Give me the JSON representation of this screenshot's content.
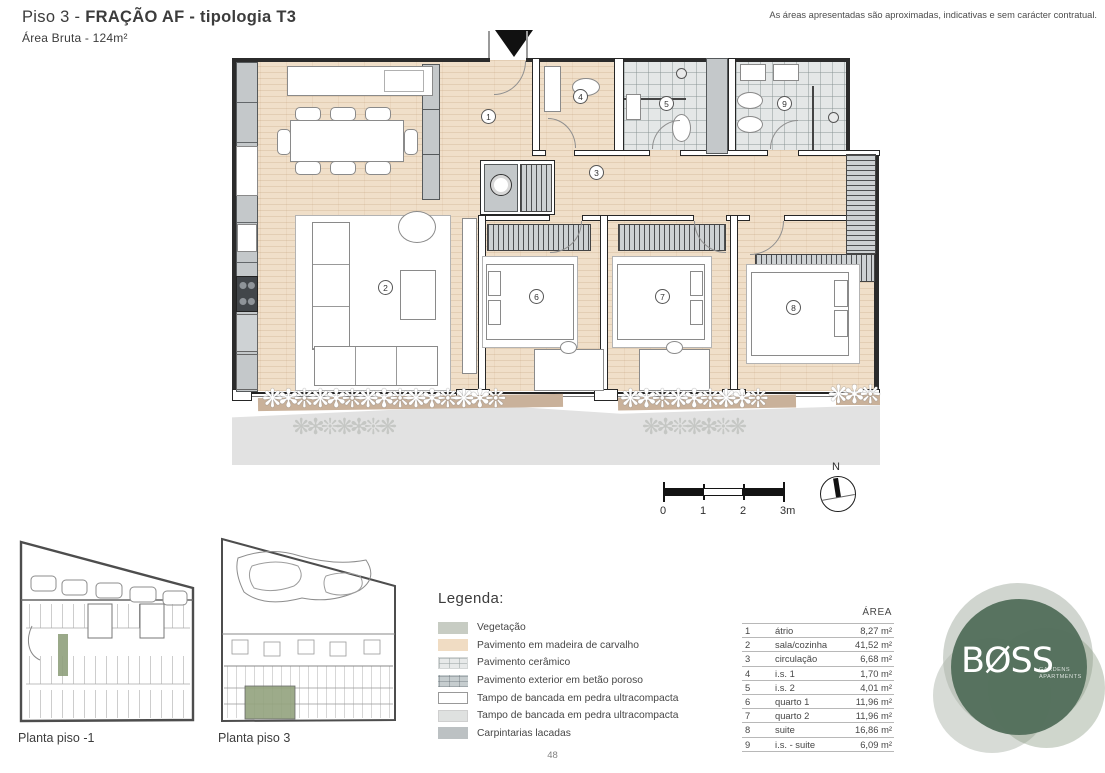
{
  "header": {
    "title_prefix": "Piso 3 - ",
    "title_bold": "FRAÇÃO AF - tipologia T3",
    "subtitle": "Área Bruta - 124m²",
    "disclaimer": "As áreas apresentadas são aproximadas, indicativas e sem carácter contratual."
  },
  "plan": {
    "room_numbers": [
      "1",
      "2",
      "3",
      "4",
      "5",
      "6",
      "7",
      "8",
      "9"
    ]
  },
  "scale": {
    "labels": [
      "0",
      "1",
      "2",
      "3m"
    ]
  },
  "north_label": "N",
  "site_plans": [
    {
      "label": "Planta piso -1"
    },
    {
      "label": "Planta piso 3"
    }
  ],
  "legend": {
    "title": "Legenda:",
    "items": [
      {
        "label": "Vegetação"
      },
      {
        "label": "Pavimento em madeira de carvalho"
      },
      {
        "label": "Pavimento cerâmico"
      },
      {
        "label": "Pavimento exterior em betão poroso"
      },
      {
        "label": "Tampo de bancada em pedra ultracompacta"
      },
      {
        "label": "Tampo de bancada em pedra ultracompacta"
      },
      {
        "label": "Carpintarias lacadas"
      }
    ]
  },
  "area_table": {
    "header": "ÁREA",
    "rows": [
      {
        "num": "1",
        "name": "átrio",
        "area": "8,27 m²"
      },
      {
        "num": "2",
        "name": "sala/cozinha",
        "area": "41,52 m²"
      },
      {
        "num": "3",
        "name": "circulação",
        "area": "6,68 m²"
      },
      {
        "num": "4",
        "name": "i.s. 1",
        "area": "1,70 m²"
      },
      {
        "num": "5",
        "name": "i.s. 2",
        "area": "4,01 m²"
      },
      {
        "num": "6",
        "name": "quarto 1",
        "area": "11,96 m²"
      },
      {
        "num": "7",
        "name": "quarto 2",
        "area": "11,96 m²"
      },
      {
        "num": "8",
        "name": "suite",
        "area": "16,86 m²"
      },
      {
        "num": "9",
        "name": "i.s. - suite",
        "area": "6,09 m²"
      }
    ]
  },
  "logo": {
    "name": "BØSS",
    "tagline_line1": "GARDENS",
    "tagline_line2": "APARTMENTS"
  },
  "page_number": "48",
  "decor": {
    "plants_large": "❋✻❊❋✻❊❋✻❊❋✻❊❋✻❊",
    "plants_medium": "❋✻❊❋✻❊❋✻❊",
    "plants_small": "❋✻❊",
    "plants_shadow": "❋✻❊❋✻❊❋"
  },
  "colors": {
    "brand_green": "#54705c",
    "highlight_green": "#93a37e",
    "wood_floor": "#f0dfc9",
    "ceramic_tile": "#e4e7e7",
    "carpentry_gray": "#c4c8ca"
  }
}
